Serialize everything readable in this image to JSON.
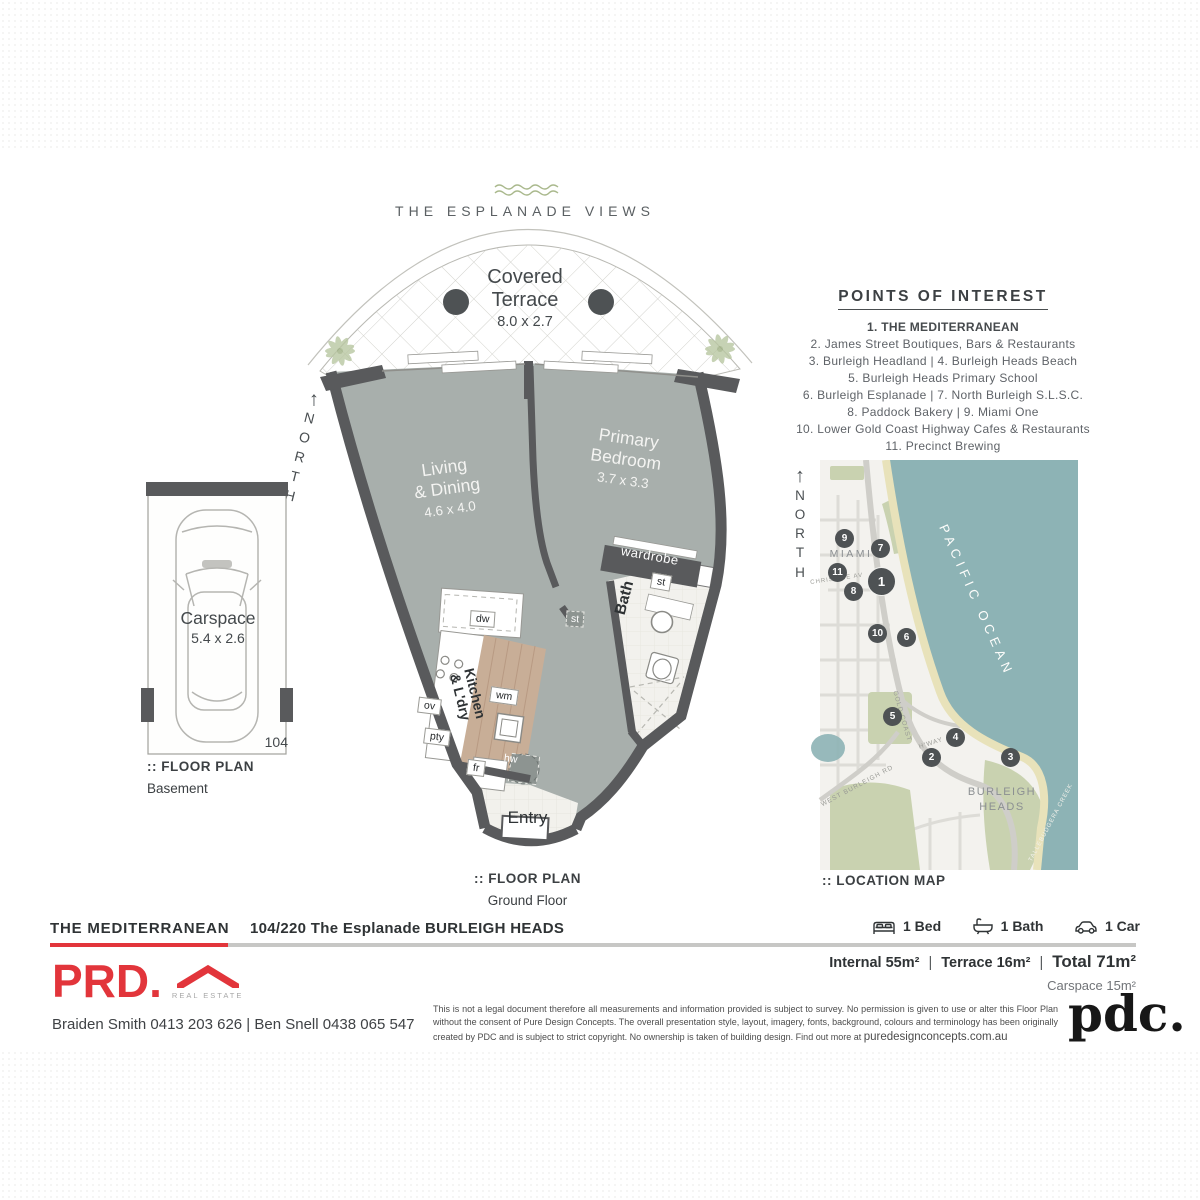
{
  "header": {
    "title": "THE ESPLANADE VIEWS"
  },
  "floor_plan": {
    "north_arrow": "↑",
    "north": "NORTH",
    "terrace": {
      "line1": "Covered",
      "line2": "Terrace",
      "dims": "8.0 x 2.7"
    },
    "living": {
      "line1": "Living",
      "line2": "& Dining",
      "dims": "4.6 x 4.0"
    },
    "bedroom": {
      "line1": "Primary",
      "line2": "Bedroom",
      "dims": "3.7 x 3.3"
    },
    "bath": "Bath",
    "wardrobe": "wardrobe",
    "entry": "Entry",
    "kitchen": {
      "line1": "Kitchen",
      "line2": "& L'dry"
    },
    "fixtures": {
      "dw": "dw",
      "ov": "ov",
      "pty": "pty",
      "wm": "wm",
      "fr": "fr",
      "hw": "hw",
      "st_hall": "st",
      "st_bath": "st"
    },
    "caption": {
      "prefix": ":: FLOOR PLAN",
      "floor": "Ground Floor"
    }
  },
  "carspace": {
    "name": "Carspace",
    "dims": "5.4 x 2.6",
    "unit": "104",
    "caption": {
      "prefix": ":: FLOOR PLAN",
      "floor": "Basement"
    }
  },
  "poi": {
    "title": "POINTS OF INTEREST",
    "lines": [
      "1. THE MEDITERRANEAN",
      "2. James Street Boutiques, Bars & Restaurants",
      "3. Burleigh Headland  |  4. Burleigh Heads Beach",
      "5. Burleigh Heads Primary School",
      "6. Burleigh Esplanade  |  7. North Burleigh S.L.S.C.",
      "8. Paddock Bakery  |  9. Miami One",
      "10. Lower Gold Coast Highway Cafes & Restaurants",
      "11. Precinct Brewing"
    ]
  },
  "map": {
    "north_arrow": "↑",
    "north": "NORTH",
    "caption": ":: LOCATION MAP",
    "ocean": "PACIFIC OCEAN",
    "suburb": "MIAMI",
    "suburb2": "BURLEIGH HEADS",
    "streets": {
      "christine": "CHRISTINE AV",
      "gold_coast": "GOLD COAST",
      "hway": "H'WAY",
      "west_burleigh": "WEST BURLEIGH RD",
      "creek": "TALLEBUDGERA CREEK"
    },
    "markers": [
      "1",
      "2",
      "3",
      "4",
      "5",
      "6",
      "7",
      "8",
      "9",
      "10",
      "11"
    ]
  },
  "footer": {
    "building": "THE MEDITERRANEAN",
    "address": "104/220 The Esplanade BURLEIGH HEADS",
    "beds": {
      "label": "1 Bed"
    },
    "baths": {
      "label": "1 Bath"
    },
    "cars": {
      "label": "1 Car"
    },
    "areas": {
      "internal": "Internal 55m²",
      "terrace": "Terrace 16m²",
      "total": "Total 71m²",
      "carspace": "Carspace 15m²",
      "sep": "|"
    },
    "brand": {
      "prd": "PRD.",
      "real_estate": "REAL ESTATE",
      "pdc": "pdc."
    },
    "agents": "Braiden Smith 0413 203 626  |  Ben Snell 0438 065 547",
    "disclaimer": "This is not a legal document therefore all measurements and information provided is subject to survey. No permission is given to use or alter this Floor Plan without the consent of Pure Design Concepts. The overall presentation style, layout, imagery, fonts, background, colours and terminology has been originally created by PDC and is subject to strict copyright. No ownership is taken of building design. Find out more at ",
    "disclaimer_link": "puredesignconcepts.com.au"
  }
}
